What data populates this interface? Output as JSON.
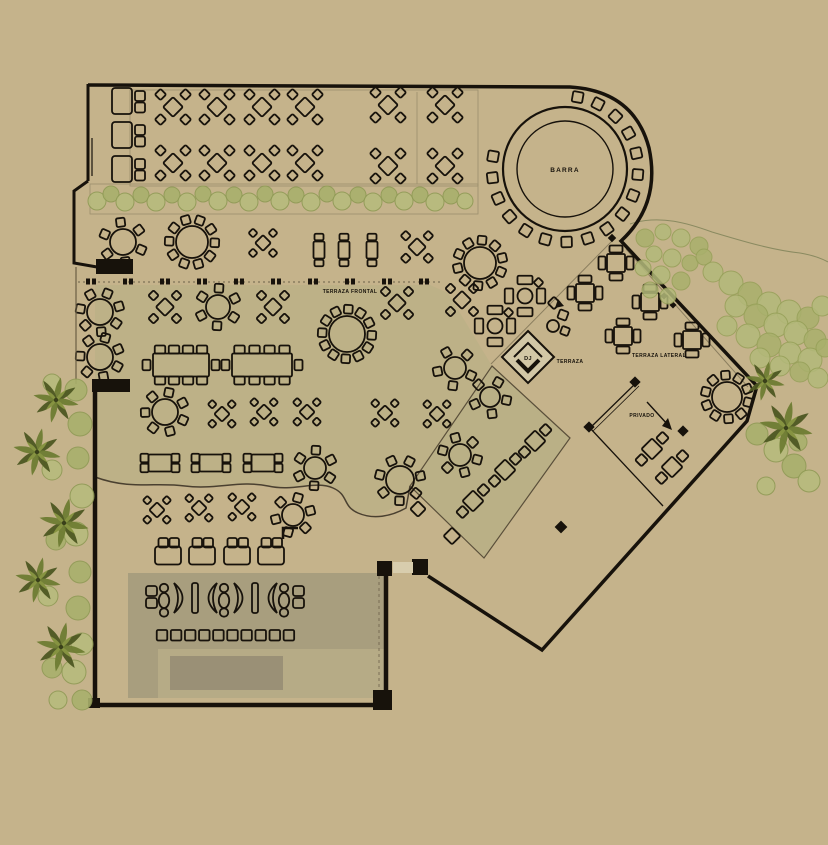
{
  "canvas": {
    "w": 828,
    "h": 845
  },
  "colors": {
    "bg": "#c5b38b",
    "ink": "#17120b",
    "tint": "#bdb187",
    "diamondFill": "#bab086",
    "loungeBand": "#a89e7e",
    "loungeInset": "#b6ab86",
    "stage": "#9a9076",
    "doorGap": "#d8cdad",
    "djFill": "#d2c7a6",
    "faint": "#8a7d5e",
    "planterLine": "#9c8f6d",
    "curvy": "#4a4030",
    "bushFillA": "#b7bb7d",
    "bushFillB": "#a9b06c",
    "bushStroke": "#8f9a55",
    "treeFill": "#b3b97a",
    "treeStroke": "#96a058",
    "palmDark": "#4d5722",
    "palmMid": "#6e7c33",
    "palmLight": "#93a149",
    "contour": "#8a8a60"
  },
  "labels": [
    {
      "id": "barra",
      "text": "BARRA",
      "x": 565,
      "y": 172,
      "size": 6.5,
      "ls": 1.2
    },
    {
      "id": "terraza-frontal",
      "text": "TERRAZA FRONTAL",
      "x": 350,
      "y": 293,
      "size": 5,
      "ls": 0.4
    },
    {
      "id": "terraza",
      "text": "TERRAZA",
      "x": 570,
      "y": 363,
      "size": 5,
      "ls": 0.4
    },
    {
      "id": "terraza-lateral",
      "text": "TERRAZA LATERAL",
      "x": 659,
      "y": 357,
      "size": 5,
      "ls": 0.4
    },
    {
      "id": "privado",
      "text": "PRIVADO",
      "x": 642,
      "y": 417,
      "size": 5,
      "ls": 0.4
    },
    {
      "id": "dj",
      "text": "DJ",
      "x": 528,
      "y": 360,
      "size": 5.5,
      "ls": 0.3
    }
  ],
  "bar": {
    "cx": 565,
    "cy": 169,
    "rOuter": 62,
    "rInner": 48,
    "stools": 17,
    "stoolR": 73,
    "a0": -80,
    "step": 16.875,
    "stoolSize": 10.5
  },
  "areas": {
    "tint": "M95,285 L430,285 L448,293 L492,366 L410,486 C396,513 376,519 358,512 C342,506 349,495 333,488 C315,480 295,492 268,486 C240,480 215,490 185,486 C155,482 130,490 95,477 Z",
    "diamondRoom": "M492,366 L570,438 L484,558 L410,486 Z",
    "loungeBand": [
      128,
      573,
      258,
      76
    ],
    "loungeArm": [
      128,
      648,
      30,
      50
    ],
    "loungeInset": [
      158,
      649,
      228,
      49
    ],
    "stage": [
      170,
      656,
      113,
      34
    ],
    "planter": [
      90,
      184,
      388,
      30
    ],
    "tableArea": [
      130,
      90,
      348,
      96
    ],
    "tableAreaLine": "M417,92 L417,184",
    "contour": "M630,224 C660,214 690,224 712,232 C742,241 772,250 800,253 C812,255 821,258 828,262"
  },
  "walls": {
    "outer": "M88,85 L570,87 Q634,91 649,148 Q661,204 621,241 L757,386 L747,421 L542,650 L428,576",
    "leftTop": "M88,84 L88,181 M88,181 L74,191 L74,263 L97,267",
    "leftBottom": "M95,390 L95,707",
    "bottom": "M92,705 L390,705",
    "loungeRight": "M386,574 L386,703",
    "doorLeaf": "M92,138 L92,176",
    "alcove": "M76,267 L76,384",
    "innerDashed": "M379,576 L379,698",
    "pillars": [
      [
        96,
        259,
        37,
        15
      ],
      [
        92,
        379,
        38,
        13
      ],
      [
        377,
        561,
        15,
        15
      ],
      [
        412,
        559,
        16,
        16
      ],
      [
        373,
        690,
        19,
        20
      ],
      [
        88,
        698,
        12,
        10
      ]
    ],
    "doorGap": [
      393,
      562,
      20,
      11
    ],
    "fence": [
      "M636,383 L590,428",
      "M639,386 L593,431",
      "M590,428 L663,506"
    ],
    "faintLines": [
      "M612,241 L491,364",
      "M626,249 L748,387"
    ],
    "dashRow": {
      "x1": 78,
      "x2": 440,
      "y": 282,
      "ticks": [
        86,
        123,
        160,
        197,
        234,
        271,
        308,
        345,
        382,
        419
      ]
    },
    "curvy": "M95,477 C130,490 155,482 185,486 C215,490 240,480 268,486 C295,492 315,480 333,488 C349,495 342,506 358,513 C374,520 392,516 406,508 L410,486",
    "bumps": [
      [
        418,
        509,
        11
      ],
      [
        452,
        536,
        12
      ]
    ],
    "markers": [
      [
        612,
        238,
        6
      ],
      [
        635,
        382,
        8
      ],
      [
        589,
        427,
        8
      ],
      [
        683,
        431,
        8
      ],
      [
        561,
        527,
        9
      ],
      [
        664,
        296,
        5
      ],
      [
        673,
        305,
        5
      ]
    ],
    "lmark": "M283,539 L283,528 L298,528",
    "arrow": {
      "path": "M647,402 L668,425",
      "head": "M672,430 L662,426 L668,418 Z"
    }
  },
  "dj": {
    "outer": "M528,331 L554,357 L528,383 L502,357 Z",
    "inner": "M514,357 L528,343 L542,357",
    "inner2": "M517,360 L528,371 L539,360"
  },
  "furniture": {
    "xt4": [
      [
        173,
        107,
        1
      ],
      [
        217,
        107,
        1
      ],
      [
        262,
        107,
        1
      ],
      [
        305,
        107,
        1
      ],
      [
        388,
        105,
        1
      ],
      [
        445,
        105,
        1
      ],
      [
        173,
        163,
        1
      ],
      [
        217,
        163,
        1
      ],
      [
        262,
        163,
        1
      ],
      [
        305,
        163,
        1
      ],
      [
        388,
        166,
        1
      ],
      [
        445,
        166,
        1
      ],
      [
        417,
        247,
        0.9
      ],
      [
        263,
        243,
        0.8
      ],
      [
        165,
        307,
        0.92
      ],
      [
        273,
        307,
        0.92
      ],
      [
        397,
        303,
        0.92
      ],
      [
        462,
        300,
        0.92
      ],
      [
        222,
        414,
        0.78
      ],
      [
        264,
        412,
        0.78
      ],
      [
        307,
        412,
        0.78
      ],
      [
        385,
        413,
        0.78
      ],
      [
        437,
        414,
        0.78
      ],
      [
        157,
        510,
        0.78
      ],
      [
        199,
        508,
        0.78
      ],
      [
        242,
        507,
        0.78
      ]
    ],
    "round": [
      [
        123,
        242,
        13,
        6
      ],
      [
        192,
        242,
        16,
        10
      ],
      [
        480,
        263,
        16,
        10
      ],
      [
        218,
        307,
        12,
        6
      ],
      [
        347,
        334,
        18,
        12
      ],
      [
        100,
        312,
        13,
        7
      ],
      [
        100,
        357,
        13,
        7
      ],
      [
        165,
        412,
        13,
        7
      ],
      [
        315,
        468,
        11,
        6
      ],
      [
        293,
        515,
        11,
        6
      ],
      [
        460,
        455,
        11,
        6
      ],
      [
        400,
        480,
        14,
        7
      ],
      [
        490,
        397,
        10,
        5
      ],
      [
        455,
        368,
        11,
        5
      ],
      [
        727,
        397,
        15,
        10
      ]
    ],
    "rect2": [
      [
        319,
        250
      ],
      [
        344,
        250
      ],
      [
        372,
        250
      ]
    ],
    "long8": [
      [
        181,
        365,
        56
      ],
      [
        262,
        365,
        60
      ]
    ],
    "rect4lr": [
      [
        160,
        463
      ],
      [
        211,
        463
      ],
      [
        263,
        463
      ]
    ],
    "plus": [
      [
        585,
        293
      ],
      [
        616,
        263
      ],
      [
        650,
        302
      ],
      [
        623,
        336
      ],
      [
        692,
        340
      ]
    ],
    "game": [
      [
        525,
        296
      ],
      [
        495,
        326
      ]
    ],
    "diag2": [
      [
        535,
        441
      ],
      [
        505,
        470
      ],
      [
        473,
        501
      ],
      [
        652,
        449
      ],
      [
        672,
        467
      ]
    ],
    "sofaV": [
      [
        112,
        88
      ],
      [
        112,
        122
      ],
      [
        112,
        156
      ]
    ],
    "sofaH": [
      [
        155,
        538
      ],
      [
        189,
        538
      ],
      [
        224,
        538
      ],
      [
        258,
        538
      ]
    ],
    "smallset": {
      "circle": [
        553,
        326,
        6
      ],
      "squares": [
        [
          563,
          315,
          9
        ],
        [
          565,
          331,
          8
        ]
      ]
    },
    "decor": {
      "diamond": [
        554,
        303,
        9
      ],
      "tri": "M558,299 L564,306 L555,308 Z"
    },
    "stoolRow": {
      "x0": 162,
      "y": 630,
      "n": 10,
      "dx": 14.1,
      "s": 10.5
    },
    "loungeRow": [
      [
        "sq2",
        146
      ],
      [
        "col",
        159
      ],
      [
        "mr",
        174
      ],
      [
        "bar",
        192
      ],
      [
        "ml",
        201
      ],
      [
        "col",
        219
      ],
      [
        "mr",
        234
      ],
      [
        "bar",
        252
      ],
      [
        "ml",
        261
      ],
      [
        "col",
        279
      ],
      [
        "sq2",
        293
      ]
    ]
  },
  "vegetation": {
    "planterBushes": [
      [
        97,
        201,
        9
      ],
      [
        111,
        194,
        8
      ],
      [
        125,
        202,
        9
      ],
      [
        141,
        195,
        8
      ],
      [
        156,
        202,
        9
      ],
      [
        172,
        195,
        8
      ],
      [
        187,
        202,
        9
      ],
      [
        203,
        194,
        8
      ],
      [
        218,
        201,
        9
      ],
      [
        234,
        195,
        8
      ],
      [
        249,
        202,
        9
      ],
      [
        265,
        194,
        8
      ],
      [
        280,
        201,
        9
      ],
      [
        296,
        195,
        8
      ],
      [
        311,
        202,
        9
      ],
      [
        327,
        194,
        8
      ],
      [
        342,
        201,
        9
      ],
      [
        358,
        195,
        8
      ],
      [
        373,
        202,
        9
      ],
      [
        389,
        195,
        8
      ],
      [
        404,
        201,
        9
      ],
      [
        420,
        195,
        8
      ],
      [
        435,
        202,
        9
      ],
      [
        451,
        196,
        8
      ],
      [
        465,
        201,
        8
      ]
    ],
    "treesTopRight": [
      [
        645,
        238,
        9
      ],
      [
        663,
        232,
        8
      ],
      [
        681,
        238,
        9
      ],
      [
        699,
        246,
        9
      ],
      [
        654,
        254,
        8
      ],
      [
        672,
        258,
        9
      ],
      [
        690,
        263,
        8
      ],
      [
        643,
        268,
        8
      ],
      [
        661,
        275,
        9
      ],
      [
        681,
        281,
        9
      ],
      [
        650,
        290,
        8
      ],
      [
        668,
        296,
        8
      ],
      [
        704,
        257,
        8
      ],
      [
        713,
        272,
        10
      ],
      [
        731,
        283,
        12
      ],
      [
        750,
        294,
        12
      ],
      [
        769,
        304,
        12
      ],
      [
        789,
        312,
        12
      ],
      [
        808,
        318,
        11
      ],
      [
        822,
        306,
        10
      ],
      [
        736,
        306,
        11
      ],
      [
        756,
        316,
        12
      ],
      [
        776,
        325,
        12
      ],
      [
        796,
        333,
        12
      ],
      [
        815,
        340,
        11
      ],
      [
        727,
        326,
        10
      ],
      [
        748,
        336,
        12
      ],
      [
        769,
        345,
        12
      ],
      [
        790,
        353,
        11
      ],
      [
        810,
        360,
        12
      ],
      [
        825,
        348,
        9
      ],
      [
        760,
        358,
        10
      ],
      [
        780,
        366,
        10
      ],
      [
        800,
        372,
        10
      ],
      [
        818,
        378,
        10
      ]
    ],
    "bushesLeft": [
      [
        76,
        390,
        11
      ],
      [
        52,
        383,
        9
      ],
      [
        80,
        424,
        12
      ],
      [
        52,
        470,
        10
      ],
      [
        78,
        458,
        11
      ],
      [
        82,
        496,
        12
      ],
      [
        56,
        540,
        10
      ],
      [
        76,
        534,
        12
      ],
      [
        80,
        572,
        11
      ],
      [
        48,
        596,
        10
      ],
      [
        78,
        608,
        12
      ],
      [
        82,
        644,
        11
      ],
      [
        52,
        668,
        10
      ],
      [
        74,
        672,
        12
      ],
      [
        82,
        700,
        10
      ],
      [
        58,
        700,
        9
      ]
    ],
    "bushesRight": [
      [
        757,
        434,
        11
      ],
      [
        776,
        450,
        12
      ],
      [
        794,
        466,
        12
      ],
      [
        809,
        481,
        11
      ],
      [
        798,
        442,
        9
      ],
      [
        766,
        486,
        9
      ]
    ],
    "palmsLeft": [
      [
        56,
        400,
        23
      ],
      [
        37,
        452,
        24
      ],
      [
        64,
        523,
        25
      ],
      [
        38,
        580,
        23
      ],
      [
        61,
        647,
        25
      ]
    ],
    "palmsRight": [
      [
        765,
        381,
        20
      ],
      [
        786,
        428,
        27
      ]
    ]
  }
}
